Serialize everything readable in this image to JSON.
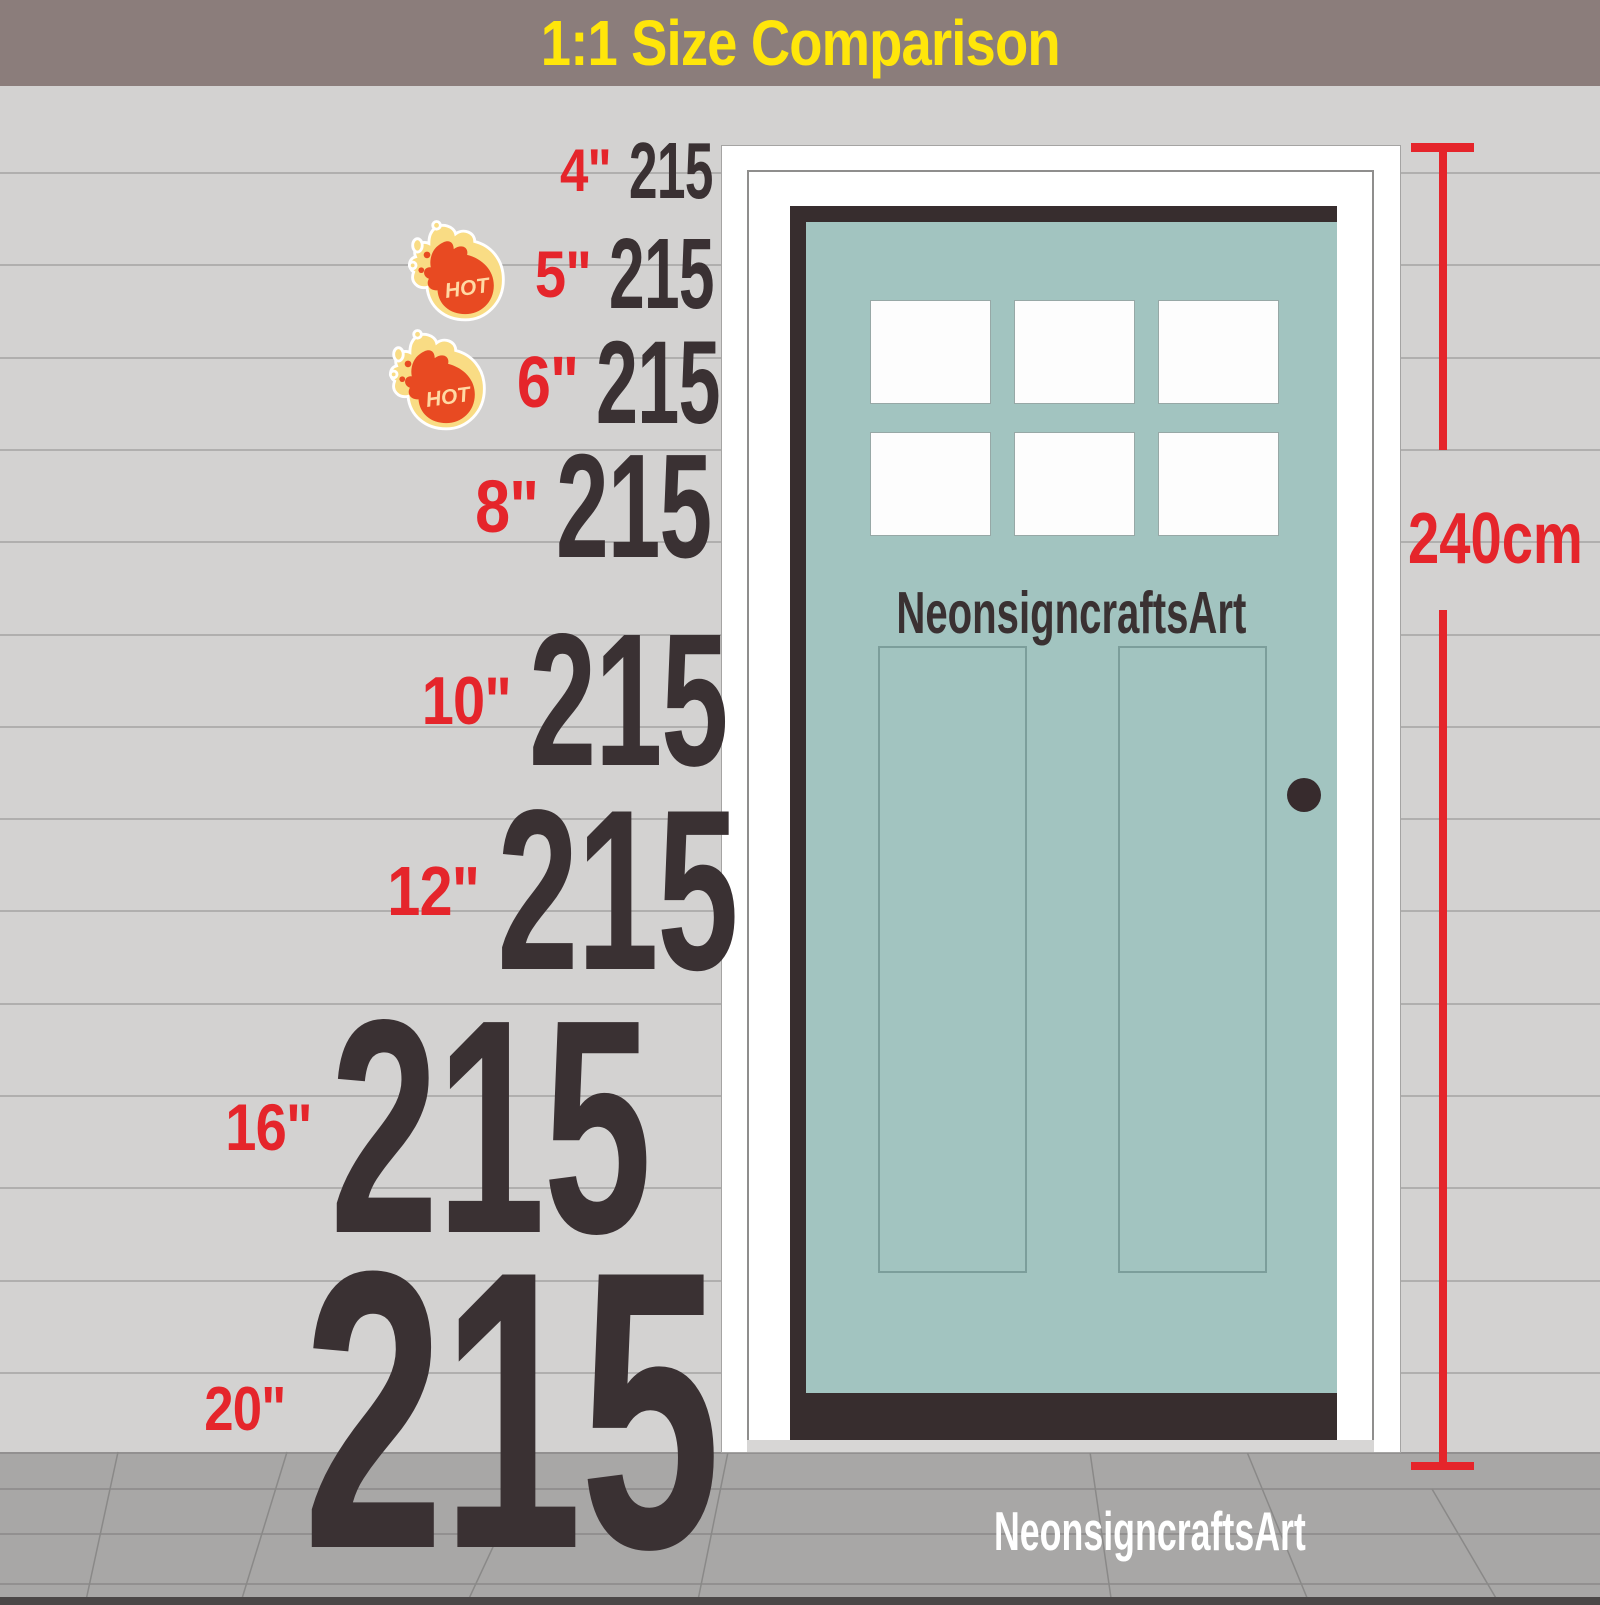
{
  "title": "1:1  Size Comparison",
  "house_number": "215",
  "door": {
    "brand_label": "NeonsigncraftsArt",
    "height_label": "240cm",
    "color": "#a2c4c0"
  },
  "watermark": "NeonsigncraftsArt",
  "hot_label": "HOT",
  "rows": [
    {
      "size": "4\"",
      "value": "215",
      "hot": false
    },
    {
      "size": "5\"",
      "value": "215",
      "hot": true
    },
    {
      "size": "6\"",
      "value": "215",
      "hot": true
    },
    {
      "size": "8\"",
      "value": "215",
      "hot": false
    },
    {
      "size": "10\"",
      "value": "215",
      "hot": false
    },
    {
      "size": "12\"",
      "value": "215",
      "hot": false
    },
    {
      "size": "16\"",
      "value": "215",
      "hot": false
    },
    {
      "size": "20\"",
      "value": "215",
      "hot": false
    }
  ],
  "colors": {
    "accent_red": "#e5252b",
    "title_yellow": "#ffe60a",
    "header_bar": "#8b7d7b",
    "number_ink": "#3a3133",
    "door_teal": "#a2c4c0",
    "wall": "#d3d2d1"
  }
}
